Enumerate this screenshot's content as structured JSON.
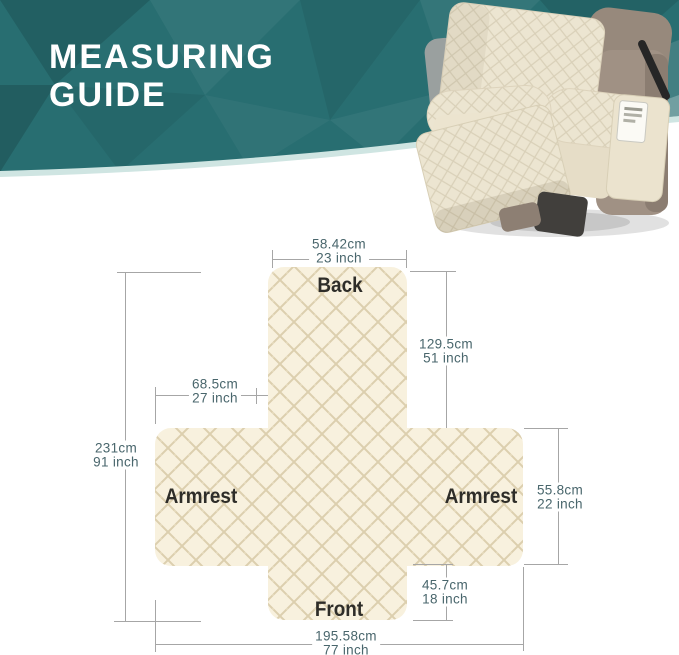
{
  "header": {
    "title_line1": "MEASURING",
    "title_line2": "GUIDE",
    "photo": "recliner-chair-with-beige-quilted-cover"
  },
  "diagram": {
    "sections": {
      "back": "Back",
      "armrest_left": "Armrest",
      "armrest_right": "Armrest",
      "front": "Front"
    },
    "dimensions": {
      "back_width": {
        "cm": "58.42cm",
        "inch": "23 inch"
      },
      "back_length": {
        "cm": "129.5cm",
        "inch": "51 inch"
      },
      "armrest_width": {
        "cm": "68.5cm",
        "inch": "27 inch"
      },
      "total_length": {
        "cm": "231cm",
        "inch": "91 inch"
      },
      "armrest_height": {
        "cm": "55.8cm",
        "inch": "22 inch"
      },
      "front_length": {
        "cm": "45.7cm",
        "inch": "18 inch"
      },
      "total_width": {
        "cm": "195.58cm",
        "inch": "77 inch"
      }
    }
  },
  "colors": {
    "banner_teal": "#286e71",
    "banner_edge_light": "#cfe5e2",
    "fabric_cream": "#f8f1de",
    "quilt_line": "#dccfae",
    "chair_frame_taupe": "#a09184",
    "dimension_text": "#49666c",
    "dimension_line": "#a6a6a6",
    "label_text": "#2e2d29"
  }
}
